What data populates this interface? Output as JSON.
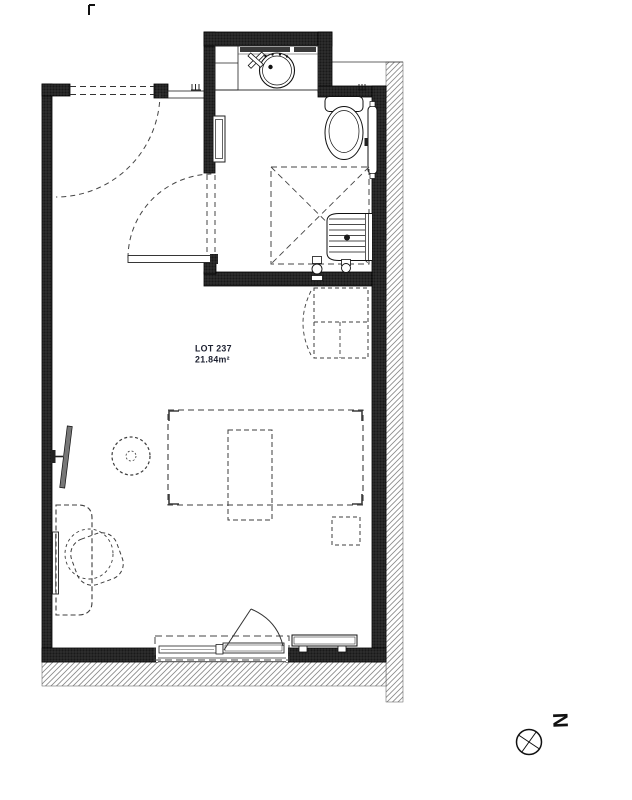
{
  "plan": {
    "lot_label": "LOT 237",
    "area_label": "21.84m²",
    "north_label": "N"
  },
  "colors": {
    "wall_fill": "#222222",
    "line": "#111111",
    "dashed_furniture": "#3d3d3d",
    "hatch": "#888888",
    "paper": "#ffffff",
    "tv_panel": "#777777"
  },
  "icons": [
    "washbasin-icon",
    "faucet-icon",
    "vanity-cabinet-icon",
    "toilet-icon",
    "towel-radiator-icon",
    "shower-bench-icon",
    "shower-valves-icon",
    "electrical-panel-icon",
    "tv-icon",
    "radiator-icon",
    "north-compass-icon"
  ],
  "furniture_outlines": [
    "bed",
    "overbed-table",
    "bedside-table",
    "wardrobe",
    "desk",
    "desk-chair",
    "stool",
    "window-surround"
  ]
}
